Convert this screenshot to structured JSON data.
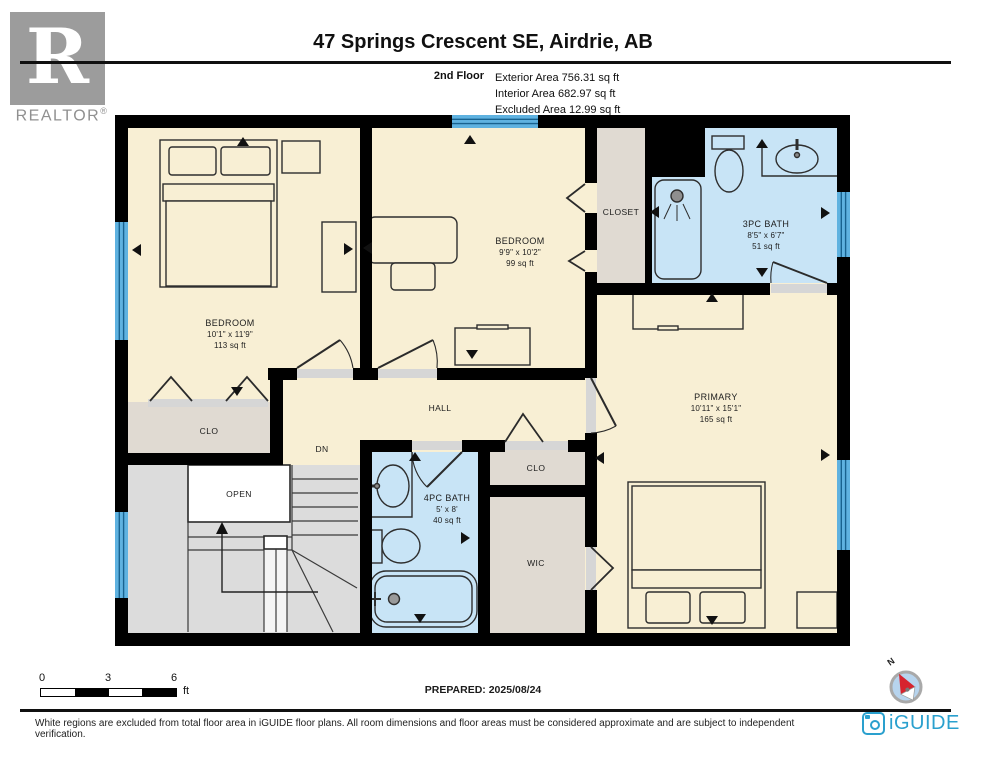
{
  "header": {
    "logo_letter": "R",
    "logo_brand": "REALTOR",
    "logo_reg": "®",
    "title": "47 Springs Crescent SE, Airdrie, AB",
    "floor_label": "2nd Floor",
    "areas": [
      "Exterior Area 756.31 sq ft",
      "Interior Area 682.97 sq ft",
      "Excluded Area 12.99 sq ft"
    ]
  },
  "rooms": {
    "bedroom_left": {
      "name": "BEDROOM",
      "dims": "10'1\" x 11'9\"",
      "area": "113 sq ft"
    },
    "bedroom_mid": {
      "name": "BEDROOM",
      "dims": "9'9\" x 10'2\"",
      "area": "99 sq ft"
    },
    "bath_3pc": {
      "name": "3PC BATH",
      "dims": "8'5\" x 6'7\"",
      "area": "51 sq ft"
    },
    "primary": {
      "name": "PRIMARY",
      "dims": "10'11\" x 15'1\"",
      "area": "165 sq ft"
    },
    "bath_4pc": {
      "name": "4PC BATH",
      "dims": "5' x 8'",
      "area": "40 sq ft"
    },
    "closet": "CLOSET",
    "clo_left": "CLO",
    "clo_right": "CLO",
    "wic": "WIC",
    "hall": "HALL",
    "open": "OPEN",
    "down": "DN"
  },
  "scale_bar": {
    "start": "0",
    "mid": "3",
    "end": "6",
    "unit": "ft"
  },
  "footer": {
    "prepared": "PREPARED: 2025/08/24",
    "disclaimer": "White regions are excluded from total floor area in iGUIDE floor plans. All room dimensions and floor areas must be considered approximate and are subject to independent verification.",
    "brand": "iGUIDE"
  },
  "compass": {
    "north": "N"
  },
  "colors": {
    "wall": "#000000",
    "room_fill": "#F8EFD4",
    "bath_fill": "#C8E4F6",
    "closet_fill": "#E0DAD2",
    "stairs_fill": "#DCDCDC",
    "window_blue": "#5FB2E0",
    "iguide_blue": "#2AA0CE",
    "compass_red": "#D6232E"
  }
}
